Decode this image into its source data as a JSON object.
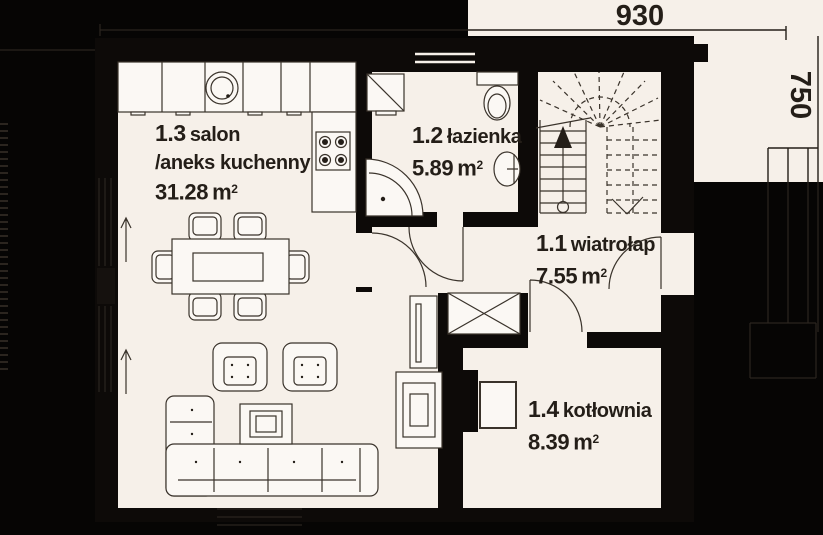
{
  "theme": {
    "bg": "#060504",
    "wall": "#0d0a08",
    "paper": "#f6f0e9",
    "furn": "#fbf8f4",
    "line": "#3a332b",
    "ink": "#241e18",
    "faint": "#2b251f"
  },
  "dimensions": {
    "width_label": "930",
    "height_label": "750"
  },
  "rooms": [
    {
      "id": "1.3",
      "name": "salon",
      "name2": "/aneks kuchenny",
      "area": "31.28",
      "unit": "m",
      "sup": "2"
    },
    {
      "id": "1.2",
      "name": "łazienka",
      "area": "5.89",
      "unit": "m",
      "sup": "2"
    },
    {
      "id": "1.1",
      "name": "wiatrołap",
      "area": "7.55",
      "unit": "m",
      "sup": "2"
    },
    {
      "id": "1.4",
      "name": "kotłownia",
      "area": "8.39",
      "unit": "m",
      "sup": "2"
    }
  ]
}
